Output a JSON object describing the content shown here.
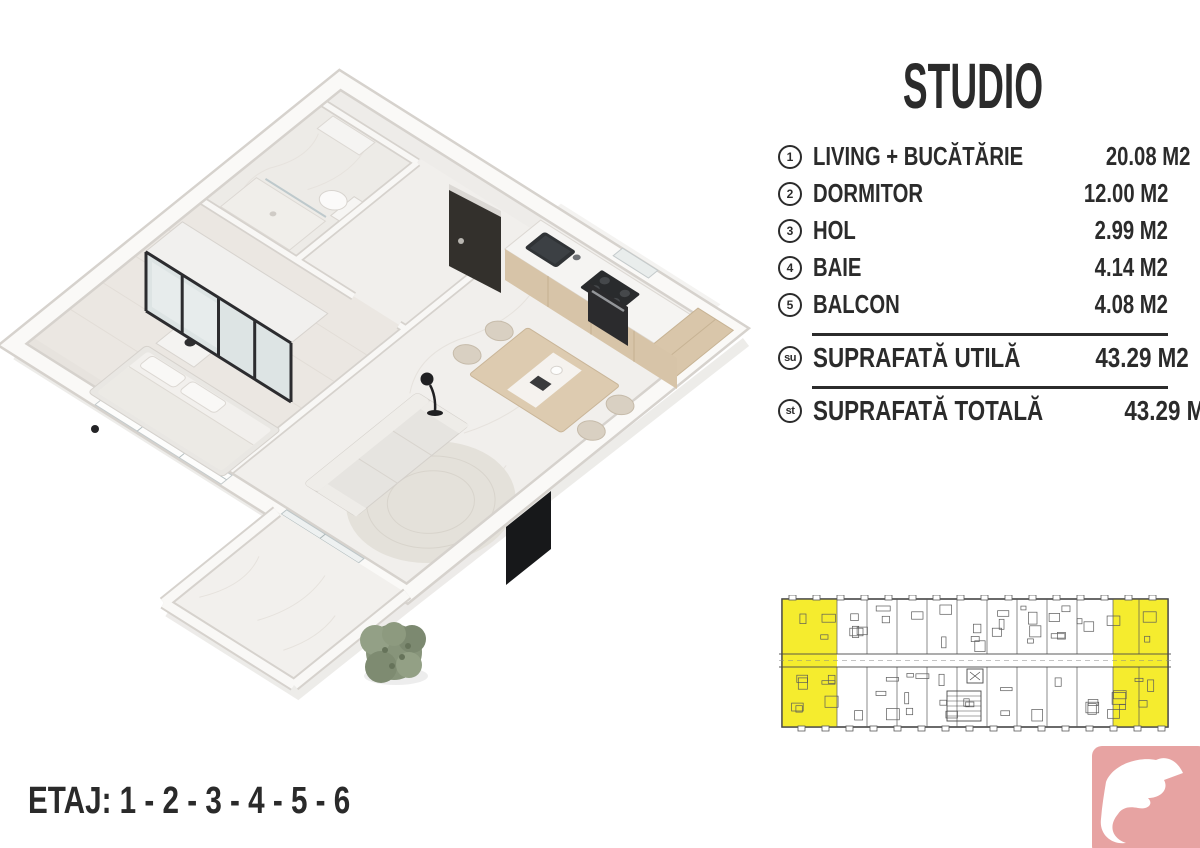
{
  "panel": {
    "title": "STUDIO",
    "text_color": "#2b2b2b",
    "rooms": [
      {
        "num": "1",
        "label": "LIVING + BUCĂTĂRIE",
        "area": "20.08 M2"
      },
      {
        "num": "2",
        "label": "DORMITOR",
        "area": "12.00 M2"
      },
      {
        "num": "3",
        "label": "HOL",
        "area": "2.99 M2"
      },
      {
        "num": "4",
        "label": "BAIE",
        "area": "4.14 M2"
      },
      {
        "num": "5",
        "label": "BALCON",
        "area": "4.08 M2"
      }
    ],
    "totals": [
      {
        "badge": "su",
        "label": "SUPRAFATĂ UTILĂ",
        "area": "43.29 M2"
      },
      {
        "badge": "st",
        "label": "SUPRAFATĂ TOTALĂ",
        "area": "43.29 M2"
      }
    ]
  },
  "floor_selector": {
    "label": "ETAJ: 1 - 2 - 3 - 4 - 5 - 6"
  },
  "building_plan": {
    "highlight_color": "#f5ec2e",
    "line_color": "#4a4a4a",
    "highlighted_units": "end units left and right"
  },
  "floor_plan_render": {
    "view": "isometric 3D studio apartment",
    "wall_color": "#faf9f7",
    "floor_color": "#f1efec",
    "wood_color": "#d8c5a9",
    "appliance_color": "#2b2c2e",
    "plant_color": "#87947a"
  },
  "logo": {
    "bg_color": "#e7a3a2",
    "icon": "dove"
  }
}
